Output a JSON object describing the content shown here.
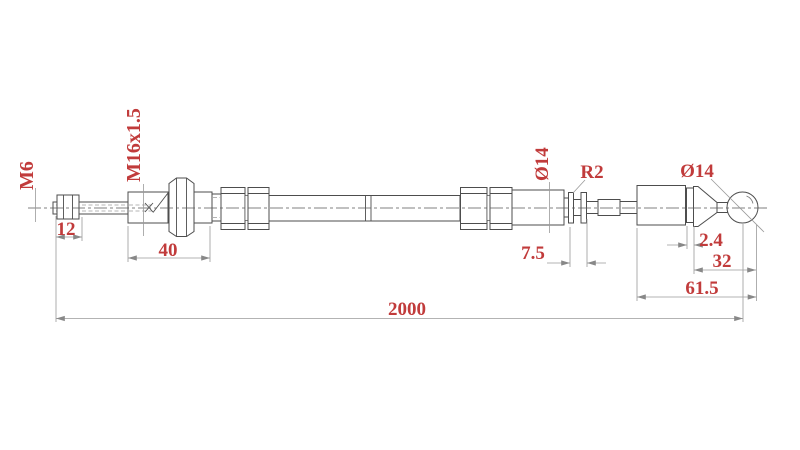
{
  "drawing": {
    "labels": {
      "m6": "M6",
      "m16": "M16x1.5",
      "dim12": "12",
      "dim40": "40",
      "dia14_groove": "Ø14",
      "r2": "R2",
      "dim7_5": "7.5",
      "dia14_ball": "Ø14",
      "dim2_4": "2.4",
      "dim32": "32",
      "dim61_5": "61.5",
      "dim2000": "2000"
    },
    "colors": {
      "dimension_text": "#c13b3b",
      "part_line": "#4d4d4d",
      "dimension_line": "#999999",
      "background": "#ffffff"
    }
  }
}
